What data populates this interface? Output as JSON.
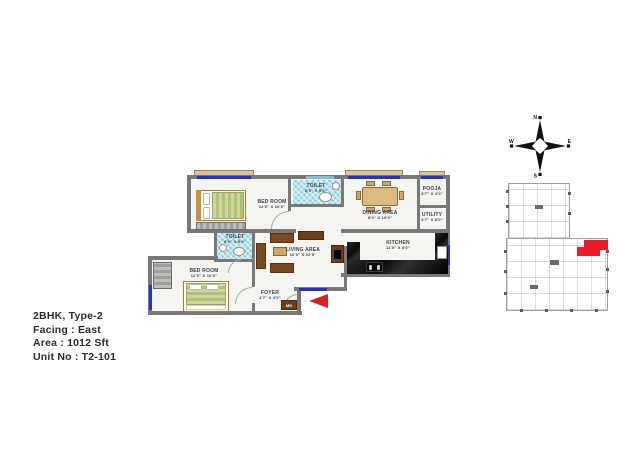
{
  "info": {
    "unit_type": "2BHK, Type-2",
    "facing": "Facing : East",
    "area": "Area : 1012 Sft",
    "unit_no": "Unit No : T2-101"
  },
  "compass": {
    "n": "N",
    "e": "E",
    "s": "S",
    "w": "W"
  },
  "rooms": {
    "bedroom1": {
      "name": "BED ROOM",
      "dim": "12'0\" X 10'0\""
    },
    "toilet1": {
      "name": "TOILET",
      "dim": "8'0\" X 5'0\""
    },
    "dining": {
      "name": "DINING AREA",
      "dim": "8'0\" X 10'0\""
    },
    "pooja": {
      "name": "POOJA",
      "dim": "3'7\" X 4'0\""
    },
    "utility": {
      "name": "UTILITY",
      "dim": "3'7\" X 8'0\""
    },
    "kitchen": {
      "name": "KITCHEN",
      "dim": "11'0\" X 8'0\""
    },
    "living": {
      "name": "LIVING AREA",
      "dim": "16'0\" X 12'0\""
    },
    "toilet2": {
      "name": "TOILET",
      "dim": "8'0\" X 5'0\""
    },
    "bedroom2": {
      "name": "BED ROOM",
      "dim": "12'0\" X 10'0\""
    },
    "foyer": {
      "name": "FOYER",
      "dim": "4'7\" X 4'0\""
    }
  },
  "door_label": "MD",
  "colors": {
    "accent_red": "#e02020",
    "highlight_red": "#ed1c24",
    "window_blue": "#2433cf",
    "wall_gray": "#787878"
  }
}
